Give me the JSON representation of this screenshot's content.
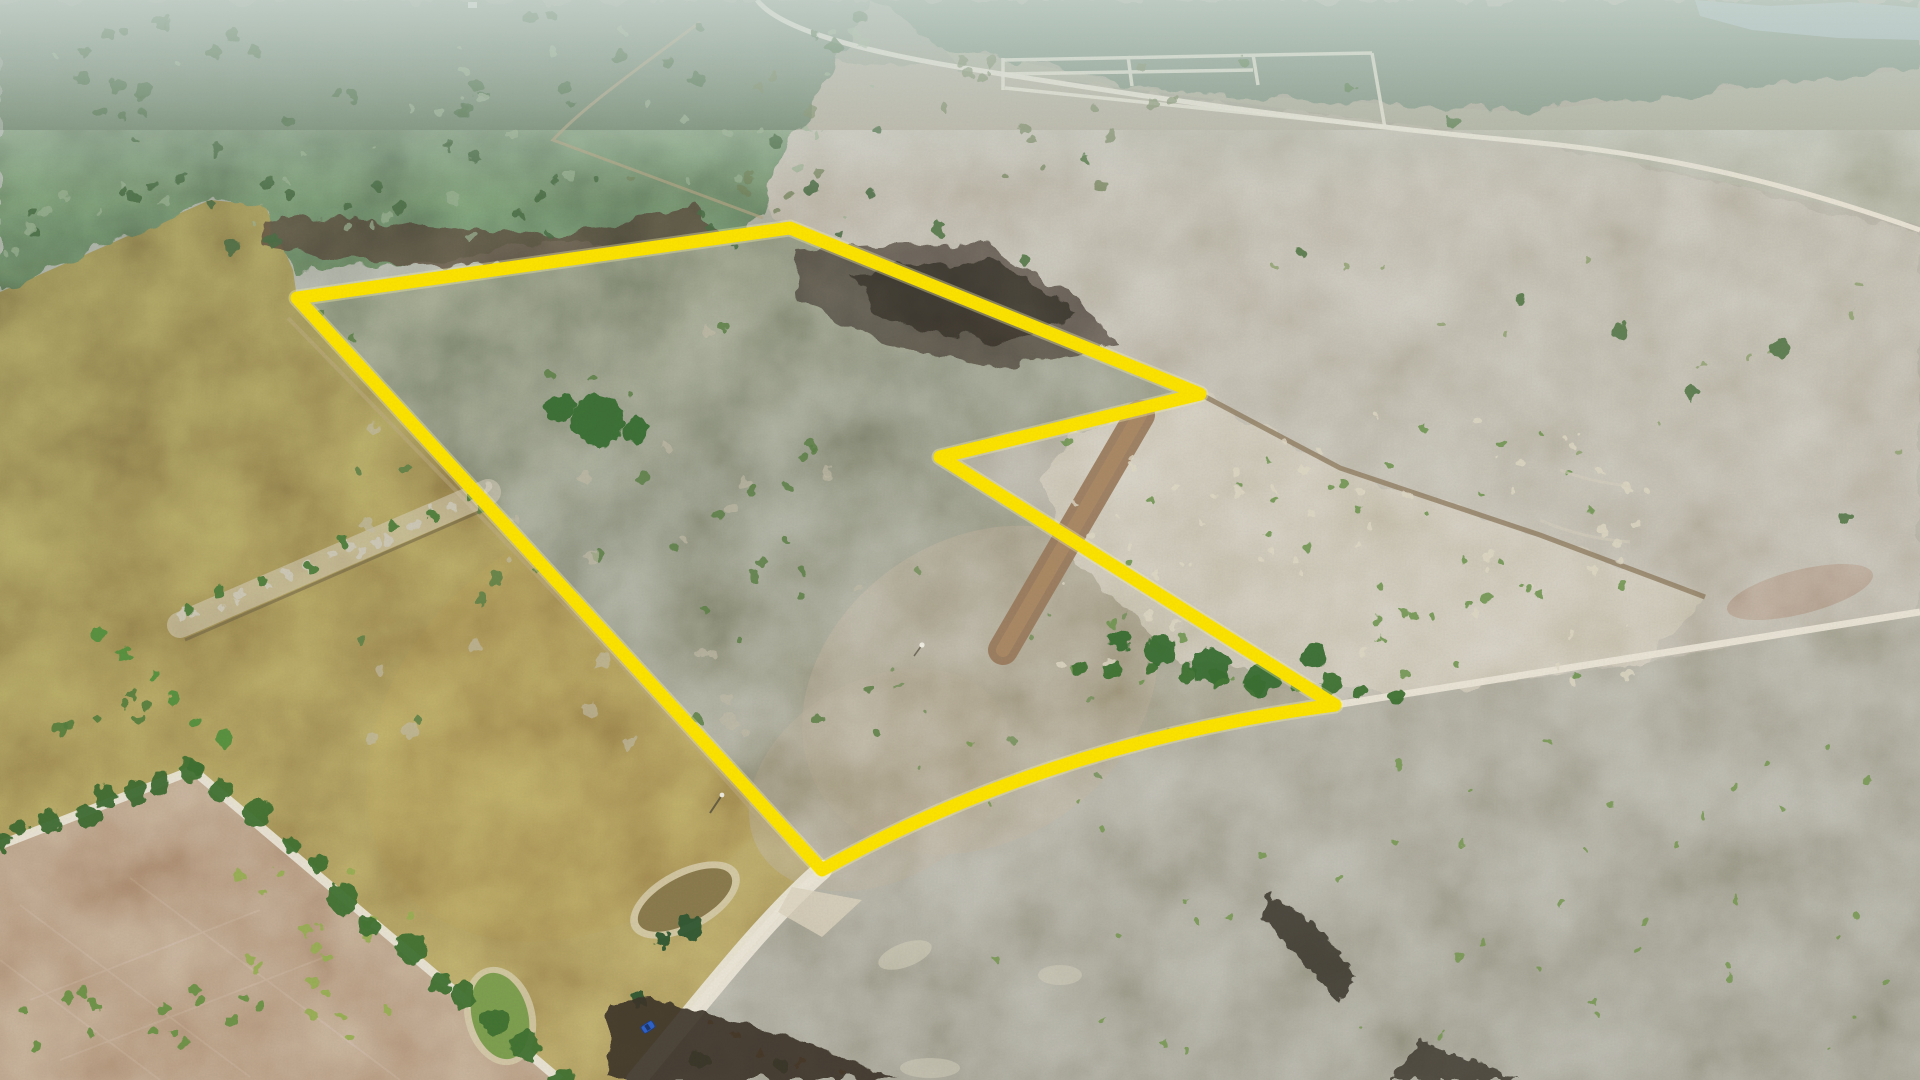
{
  "meta": {
    "title": "Aerial drone photograph of rural land with a surveyed parcel outlined in yellow",
    "image_type": "photograph-aerial"
  },
  "palette": {
    "boundary_yellow": "#ffe600",
    "boundary_halo": "#fff9a8",
    "road_white": "#ece7d8",
    "water": "#9fb4b6",
    "pond_mud": "#8c7c4e",
    "pond_green": "#7fa050",
    "pond_rim": "#d8cfae",
    "lane_brown": "#9b7b5c",
    "track_brown": "#8f7b5f",
    "trail_tan": "#b3a584",
    "burned_dark": "#453f33",
    "car_blue": "#2f63c9"
  },
  "boundary": {
    "d": "M297,298 L790,228 L1200,394 L940,457 L1335,705 C1160,728 986,778 822,870 Z",
    "color": "#ffe600",
    "halo": "#fff9a8",
    "width": 13
  },
  "roads": {
    "color": "#ece7d8",
    "main_d": "M636,1080 C700,1004 762,922 822,870 C986,778 1160,728 1335,705 C1520,676 1720,644 1920,612",
    "near_d": "M636,1080 C700,1004 762,922 822,870",
    "top_d": "M757,0 C778,28 856,50 958,67 C1100,90 1292,120 1530,142 C1702,158 1822,196 1920,230",
    "tree_d": "M0,845 L193,770 L560,1080",
    "subdivision_d": "M1003,60 L1372,53 M1003,74 L1253,70 M1005,88 L1530,142 M1003,58 L1003,90 M1128,56 L1132,86 M1253,54 L1258,85 M1372,53 L1385,128"
  },
  "features": {
    "lane_d": "M1003,650 L1140,415",
    "lane_color": "#9b7b5c",
    "track_ne_d": "M1200,394 L1340,468 L1540,535 L1705,597",
    "trail_top_d": "M700,22 C650,60 585,105 553,140 L763,218",
    "left_trail_d": "M288,318 C450,485 620,655 806,872",
    "water_points": "1695,0 1770,6 1850,2 1920,8 1920,40 1838,38 1752,30 1700,16"
  },
  "car": {
    "transform": "translate(648,1027) rotate(-33)",
    "color": "#2f63c9"
  },
  "scene": {
    "decor": [
      {
        "kind": "scatter",
        "x": 0,
        "y": 15,
        "w": 880,
        "h": 250,
        "n": 70,
        "rmin": 3,
        "rmax": 7,
        "color": "#4e7048",
        "seed": 1,
        "op": 0.85
      },
      {
        "kind": "scatter",
        "x": 0,
        "y": 25,
        "w": 880,
        "h": 240,
        "n": 45,
        "rmin": 2,
        "rmax": 6,
        "color": "#9db394",
        "seed": 2,
        "op": 0.7
      },
      {
        "kind": "scatter",
        "x": 320,
        "y": 310,
        "w": 560,
        "h": 430,
        "n": 34,
        "rmin": 3,
        "rmax": 6,
        "color": "#5d8248",
        "seed": 3,
        "op": 0.85
      },
      {
        "kind": "scatter",
        "x": 330,
        "y": 330,
        "w": 540,
        "h": 420,
        "n": 26,
        "rmin": 4,
        "rmax": 8,
        "color": "#c3bda9",
        "seed": 4,
        "op": 0.65
      },
      {
        "kind": "scatter",
        "x": 620,
        "y": 60,
        "w": 560,
        "h": 150,
        "n": 26,
        "rmin": 3,
        "rmax": 6,
        "color": "#77875f",
        "seed": 5,
        "op": 0.75
      },
      {
        "kind": "scatter",
        "x": 1060,
        "y": 415,
        "w": 600,
        "h": 270,
        "n": 62,
        "rmin": 2,
        "rmax": 5,
        "color": "#e0dac6",
        "seed": 6,
        "op": 0.8
      },
      {
        "kind": "scatter",
        "x": 1060,
        "y": 425,
        "w": 580,
        "h": 260,
        "n": 42,
        "rmin": 2,
        "rmax": 5,
        "color": "#6e9750",
        "seed": 7,
        "op": 0.85
      },
      {
        "kind": "scatter",
        "x": 880,
        "y": 560,
        "w": 300,
        "h": 240,
        "n": 12,
        "rmin": 2,
        "rmax": 4,
        "color": "#74925a",
        "seed": 8,
        "op": 0.8
      },
      {
        "kind": "scatter",
        "x": 900,
        "y": 740,
        "w": 1010,
        "h": 330,
        "n": 46,
        "rmin": 2,
        "rmax": 4,
        "color": "#74984e",
        "seed": 9,
        "op": 0.8
      },
      {
        "kind": "scatter",
        "x": 1250,
        "y": 250,
        "w": 650,
        "h": 220,
        "n": 14,
        "rmin": 2,
        "rmax": 4,
        "color": "#8aa06a",
        "seed": 10,
        "op": 0.7
      },
      {
        "kind": "scatter",
        "x": 235,
        "y": 862,
        "w": 180,
        "h": 180,
        "n": 22,
        "rmin": 3,
        "rmax": 6,
        "color": "#9ab054",
        "seed": 11,
        "op": 0.95
      },
      {
        "kind": "scatter",
        "x": 10,
        "y": 985,
        "w": 250,
        "h": 90,
        "n": 16,
        "rmin": 4,
        "rmax": 6,
        "color": "#6d9346",
        "seed": 12,
        "op": 0.95
      },
      {
        "kind": "scatter",
        "x": 0,
        "y": 690,
        "w": 160,
        "h": 80,
        "n": 7,
        "rmin": 4,
        "rmax": 7,
        "color": "#557f3e",
        "seed": 21,
        "op": 0.9
      },
      {
        "kind": "line",
        "x1": 0,
        "y1": 845,
        "x2": 193,
        "y2": 770,
        "n": 8,
        "rmin": 8,
        "rmax": 14,
        "color": "#3f6e31",
        "seed": 13,
        "jit": 8
      },
      {
        "kind": "line",
        "x1": 193,
        "y1": 770,
        "x2": 560,
        "y2": 1080,
        "n": 13,
        "rmin": 9,
        "rmax": 16,
        "color": "#417334",
        "seed": 14,
        "jit": 9
      },
      {
        "kind": "line",
        "x1": 100,
        "y1": 635,
        "x2": 225,
        "y2": 742,
        "n": 6,
        "rmin": 5,
        "rmax": 8,
        "color": "#55923f",
        "seed": 15,
        "jit": 4
      },
      {
        "kind": "line",
        "x1": 180,
        "y1": 622,
        "x2": 488,
        "y2": 492,
        "n": 20,
        "rmin": 3,
        "rmax": 6,
        "color": "#cfc9b8",
        "seed": 16,
        "jit": 10
      },
      {
        "kind": "line",
        "x1": 185,
        "y1": 615,
        "x2": 470,
        "y2": 495,
        "n": 8,
        "rmin": 4,
        "rmax": 6,
        "color": "#4f7f3d",
        "seed": 17,
        "jit": 8
      },
      {
        "kind": "line",
        "x1": 1080,
        "y1": 665,
        "x2": 1400,
        "y2": 693,
        "n": 10,
        "rmin": 6,
        "rmax": 11,
        "color": "#3f7434",
        "seed": 18,
        "jit": 5
      },
      {
        "kind": "dots",
        "pts": [
          [
            1245,
            62,
            6
          ],
          [
            1350,
            88,
            5
          ],
          [
            1455,
            122,
            7
          ],
          [
            1086,
            160,
            5
          ],
          [
            1620,
            330,
            8
          ],
          [
            1780,
            348,
            9
          ],
          [
            1690,
            392,
            7
          ],
          [
            1520,
            300,
            5
          ],
          [
            1845,
            520,
            6
          ],
          [
            1300,
            252,
            4
          ],
          [
            938,
            228,
            7
          ],
          [
            1023,
            260,
            5
          ]
        ],
        "color": "#577c4a",
        "op": 0.9
      },
      {
        "kind": "dots",
        "pts": [
          [
            1120,
            640,
            11
          ],
          [
            1160,
            650,
            15
          ],
          [
            1210,
            665,
            19
          ],
          [
            1262,
            678,
            17
          ],
          [
            1315,
            655,
            13
          ],
          [
            598,
            420,
            26
          ],
          [
            560,
            408,
            14
          ],
          [
            636,
            430,
            13
          ]
        ],
        "color": "#3a7031",
        "op": 0.95
      },
      {
        "kind": "dots",
        "pts": [
          [
            690,
            928,
            13
          ],
          [
            662,
            940,
            8
          ],
          [
            640,
            1000,
            8
          ],
          [
            700,
            1060,
            9
          ],
          [
            780,
            1065,
            8
          ]
        ],
        "color": "#2f5a33",
        "op": 0.95
      },
      {
        "kind": "dots",
        "pts": [
          [
            735,
            1035,
            4
          ],
          [
            760,
            1055,
            4
          ],
          [
            710,
            1022,
            3
          ],
          [
            800,
            1062,
            4
          ],
          [
            840,
            1072,
            3
          ]
        ],
        "color": "#b06a28",
        "op": 0.9
      }
    ]
  }
}
